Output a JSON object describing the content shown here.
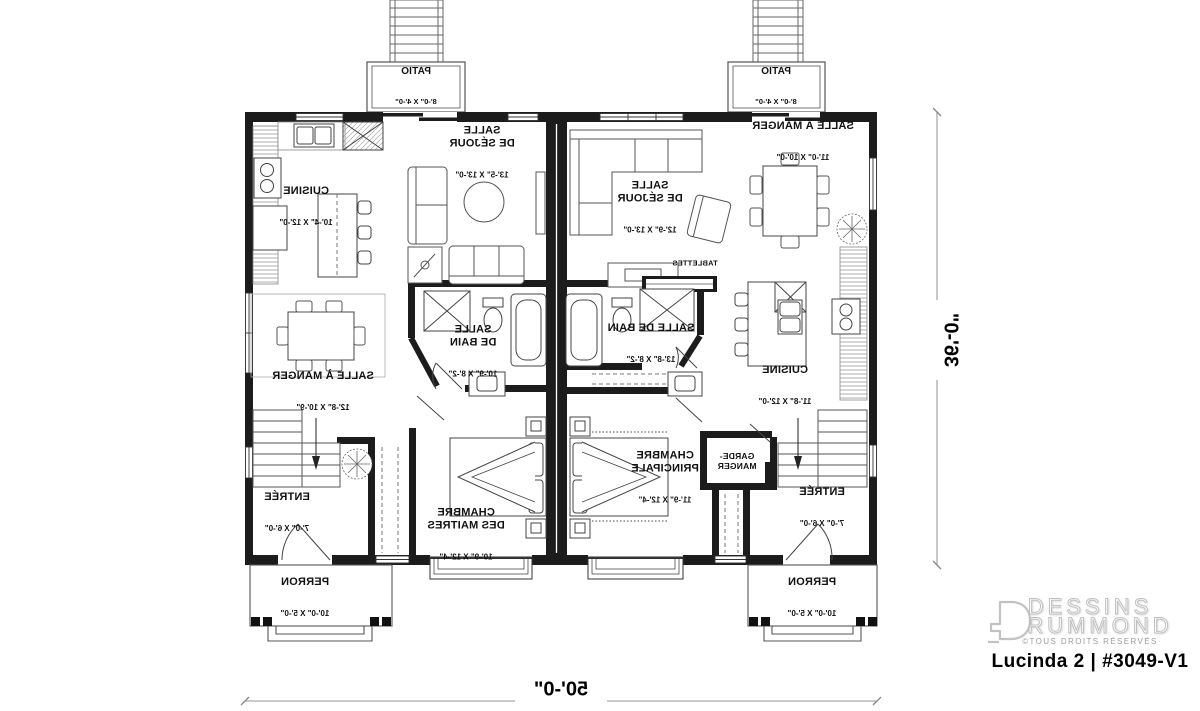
{
  "brand": {
    "line1": "DESSINS",
    "line2": "DRUMMOND",
    "copyright": "©TOUS DROITS RÉSERVÉS",
    "plan_title": "Lucinda 2 | #3049-V1"
  },
  "overall_dimensions": {
    "width": "50'-0\"",
    "depth": "36'-0\""
  },
  "rooms": {
    "left_cuisine": {
      "name": "CUISINE",
      "dims": "10'-4\" X 12'-0\""
    },
    "left_sejour": {
      "name": "SALLE\nDE SÉJOUR",
      "dims": "13'-5\" X 13'-0\""
    },
    "left_salle_a_manger": {
      "name": "SALLE À MANGER",
      "dims": "12'-8\" X 10'-9\""
    },
    "left_salle_de_bain": {
      "name": "SALLE\nDE BAIN",
      "dims": "10'-9\" X 8'-2\""
    },
    "left_chambre": {
      "name": "CHAMBRE\nDES MAITRES",
      "dims": "10'-9\" X 12'-4\""
    },
    "left_entree": {
      "name": "ENTRÉE",
      "dims": "7'-0\" X 6'-0\""
    },
    "left_patio": {
      "name": "PATIO",
      "dims": "8'-0\" X 4'-0\""
    },
    "left_perron": {
      "name": "PERRON",
      "dims": "10'-0\" X 5'-0\""
    },
    "right_salle_a_manger": {
      "name": "SALLE À MANGER",
      "dims": "11'-0\" X 10'-0\""
    },
    "right_sejour": {
      "name": "SALLE\nDE SÉJOUR",
      "dims": "12'-9\" X 13'-0\""
    },
    "right_tablettes": {
      "name": "TABLETTES"
    },
    "right_cuisine": {
      "name": "CUISINE",
      "dims": "11'-8\" X 12'-0\""
    },
    "right_salle_de_bain": {
      "name": "SALLE DE BAIN",
      "dims": "13'-8\" X 8'-2\""
    },
    "right_garde_manger": {
      "name": "GARDE-\nMANGER"
    },
    "right_chambre": {
      "name": "CHAMBRE\nPRINCIPALE",
      "dims": "11'-9\" X 12'-4\""
    },
    "right_entree": {
      "name": "ENTRÉE",
      "dims": "7'-0\" X 6'-0\""
    },
    "right_patio": {
      "name": "PATIO",
      "dims": "8'-0\" X 4'-0\""
    },
    "right_perron": {
      "name": "PERRON",
      "dims": "10'-0\" X 5'-0\""
    }
  }
}
